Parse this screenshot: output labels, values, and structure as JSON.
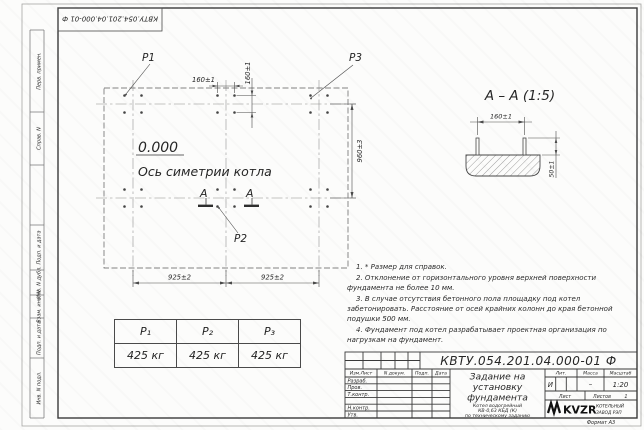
{
  "doc": {
    "number": "КВТУ.054.201.04.000-01 Ф",
    "number_top": "КВТУ.054.201.04.000-01 Ф",
    "format": "Формат А3"
  },
  "margin": {
    "labels": [
      "Перв. примен.",
      "Справ. N",
      "Подп. и дата",
      "Инв. N дубл.",
      "Взам. инв. N",
      "Подп. и дата",
      "Инв. N подл."
    ]
  },
  "plan": {
    "elevation": "0.000",
    "axis": "Ось симетрии котла",
    "dim_h160": "160±1",
    "dim_v160": "160±1",
    "dim_925_l": "925±2",
    "dim_925_r": "925±2",
    "dim_960": "960±3",
    "p1": "Р1",
    "p2": "Р2",
    "p3": "Р3",
    "section_a_left": "А",
    "section_a_right": "А"
  },
  "section": {
    "title": "А – А (1:5)",
    "dim_160": "160±1",
    "dim_50": "50±1"
  },
  "loads": {
    "headers": [
      "Р₁",
      "Р₂",
      "Р₃"
    ],
    "values": [
      "425 кг",
      "425 кг",
      "425 кг"
    ]
  },
  "notes": [
    "1. * Размер для справок.",
    "2. Отклонение от горизонтального уровня верхней поверхности фундамента не более 10 мм.",
    "3. В случае отсутствия бетонного пола площадку под котел забетонировать. Расстояние от осей крайних колонн до края бетонной подушки 500 мм.",
    "4. Фундамент под котел разрабатывает проектная организация по нагрузкам на фундамент."
  ],
  "stamp": {
    "cols": [
      "Изм.Лист",
      "N докум.",
      "Подп.",
      "Дата"
    ],
    "rows": [
      "Разраб.",
      "Пров.",
      "Т.контр.",
      "Н.контр.",
      "Утв."
    ],
    "title1": "Задание на",
    "title2": "установку",
    "title3": "фундамента",
    "sub1": "Котел водогрейный",
    "sub2": "КВ-0,63 КБД (К)",
    "sub3": "по техническому заданию",
    "lit_label": "Лит.",
    "lit": "И",
    "mass_label": "Масса",
    "mass": "–",
    "scale_label": "Масштаб",
    "scale": "1:20",
    "sheet_label": "Лист",
    "sheets_label": "Листов",
    "sheets": "1",
    "logo": "KVZR",
    "logo_line1": "КОТЕЛЬНЫЙ",
    "logo_line2": "ЗАВОД РЭП"
  }
}
